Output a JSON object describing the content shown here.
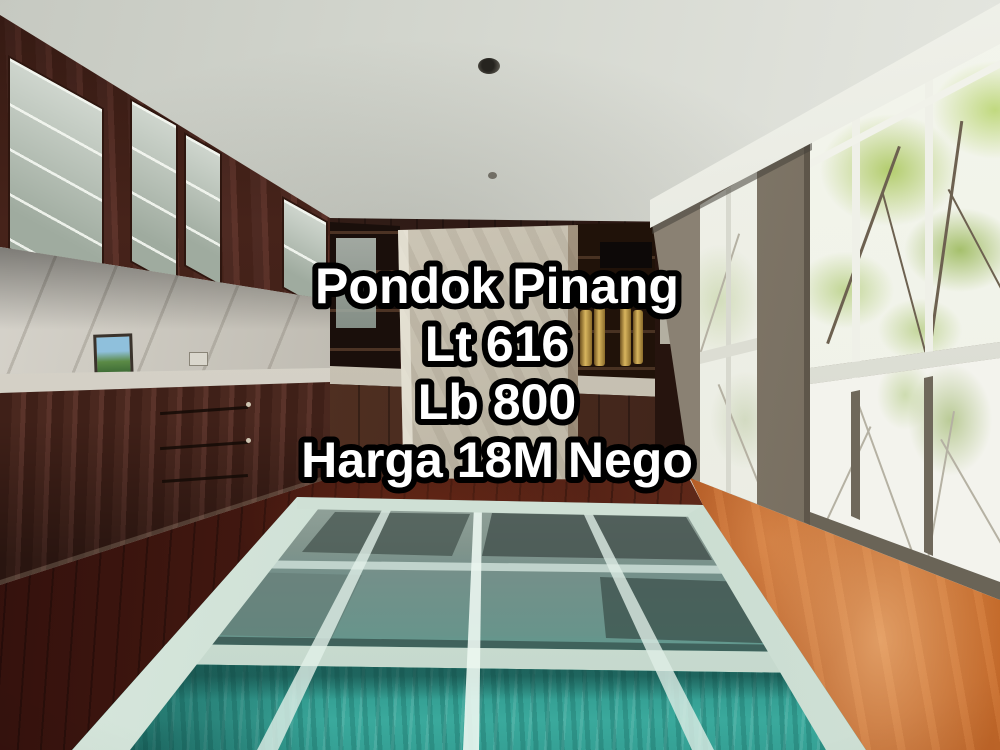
{
  "photo": {
    "alt": "Interior room with a glass floor over a swimming pool, dark wood kitchen cabinets with marble backsplash on the left, back wall shelving with a marble pillar, and large garden-view windows on the right",
    "overlay": {
      "lines": [
        "Pondok Pinang",
        "Lt 616",
        "Lb 800",
        "Harga 18M Nego"
      ],
      "text_color": "#ffffff",
      "outline_color": "#000000"
    },
    "palette": {
      "pool_teal": "#3aa096",
      "cabinet_wood": "#4b2620",
      "floor_wood_bright": "#b85a22",
      "floor_wood_dark": "#4a1c12",
      "foliage_green": "#9cbf4e",
      "marble": "#cfc9bb",
      "ceiling": "#d6d9d1"
    }
  }
}
